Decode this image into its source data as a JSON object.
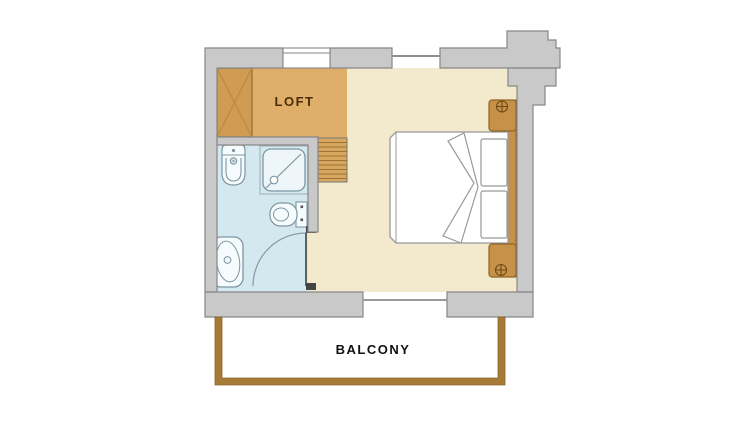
{
  "labels": {
    "loft": "LOFT",
    "balcony": "BALCONY"
  },
  "colors": {
    "background": "#ffffff",
    "wall": "#c9c9c9",
    "wall_outline": "#878787",
    "bedroom_floor": "#f3e9cc",
    "loft_floor": "#dfae68",
    "wardrobe": "#d09b52",
    "stairs": "#d7a65f",
    "stair_tread_line": "#9b7537",
    "furniture_wood": "#c8914a",
    "furniture_wood_outline": "#8d6526",
    "bathroom_floor": "#d3e8ef",
    "fixture_fill": "#f6fbfd",
    "fixture_outline": "#7e96a2",
    "bed_outline": "#999999",
    "balcony_railing": "#a67b38",
    "loft_text": "#4a2e07",
    "balcony_text": "#111111"
  },
  "fixtures": [
    "wardrobe",
    "loft-stairs",
    "double-bed",
    "pillow",
    "duvet-fold",
    "headboard",
    "nightstand",
    "lamp",
    "bidet",
    "shower",
    "toilet",
    "bathtub",
    "bathroom-door",
    "window",
    "balcony-door-opening",
    "balcony-railing"
  ]
}
